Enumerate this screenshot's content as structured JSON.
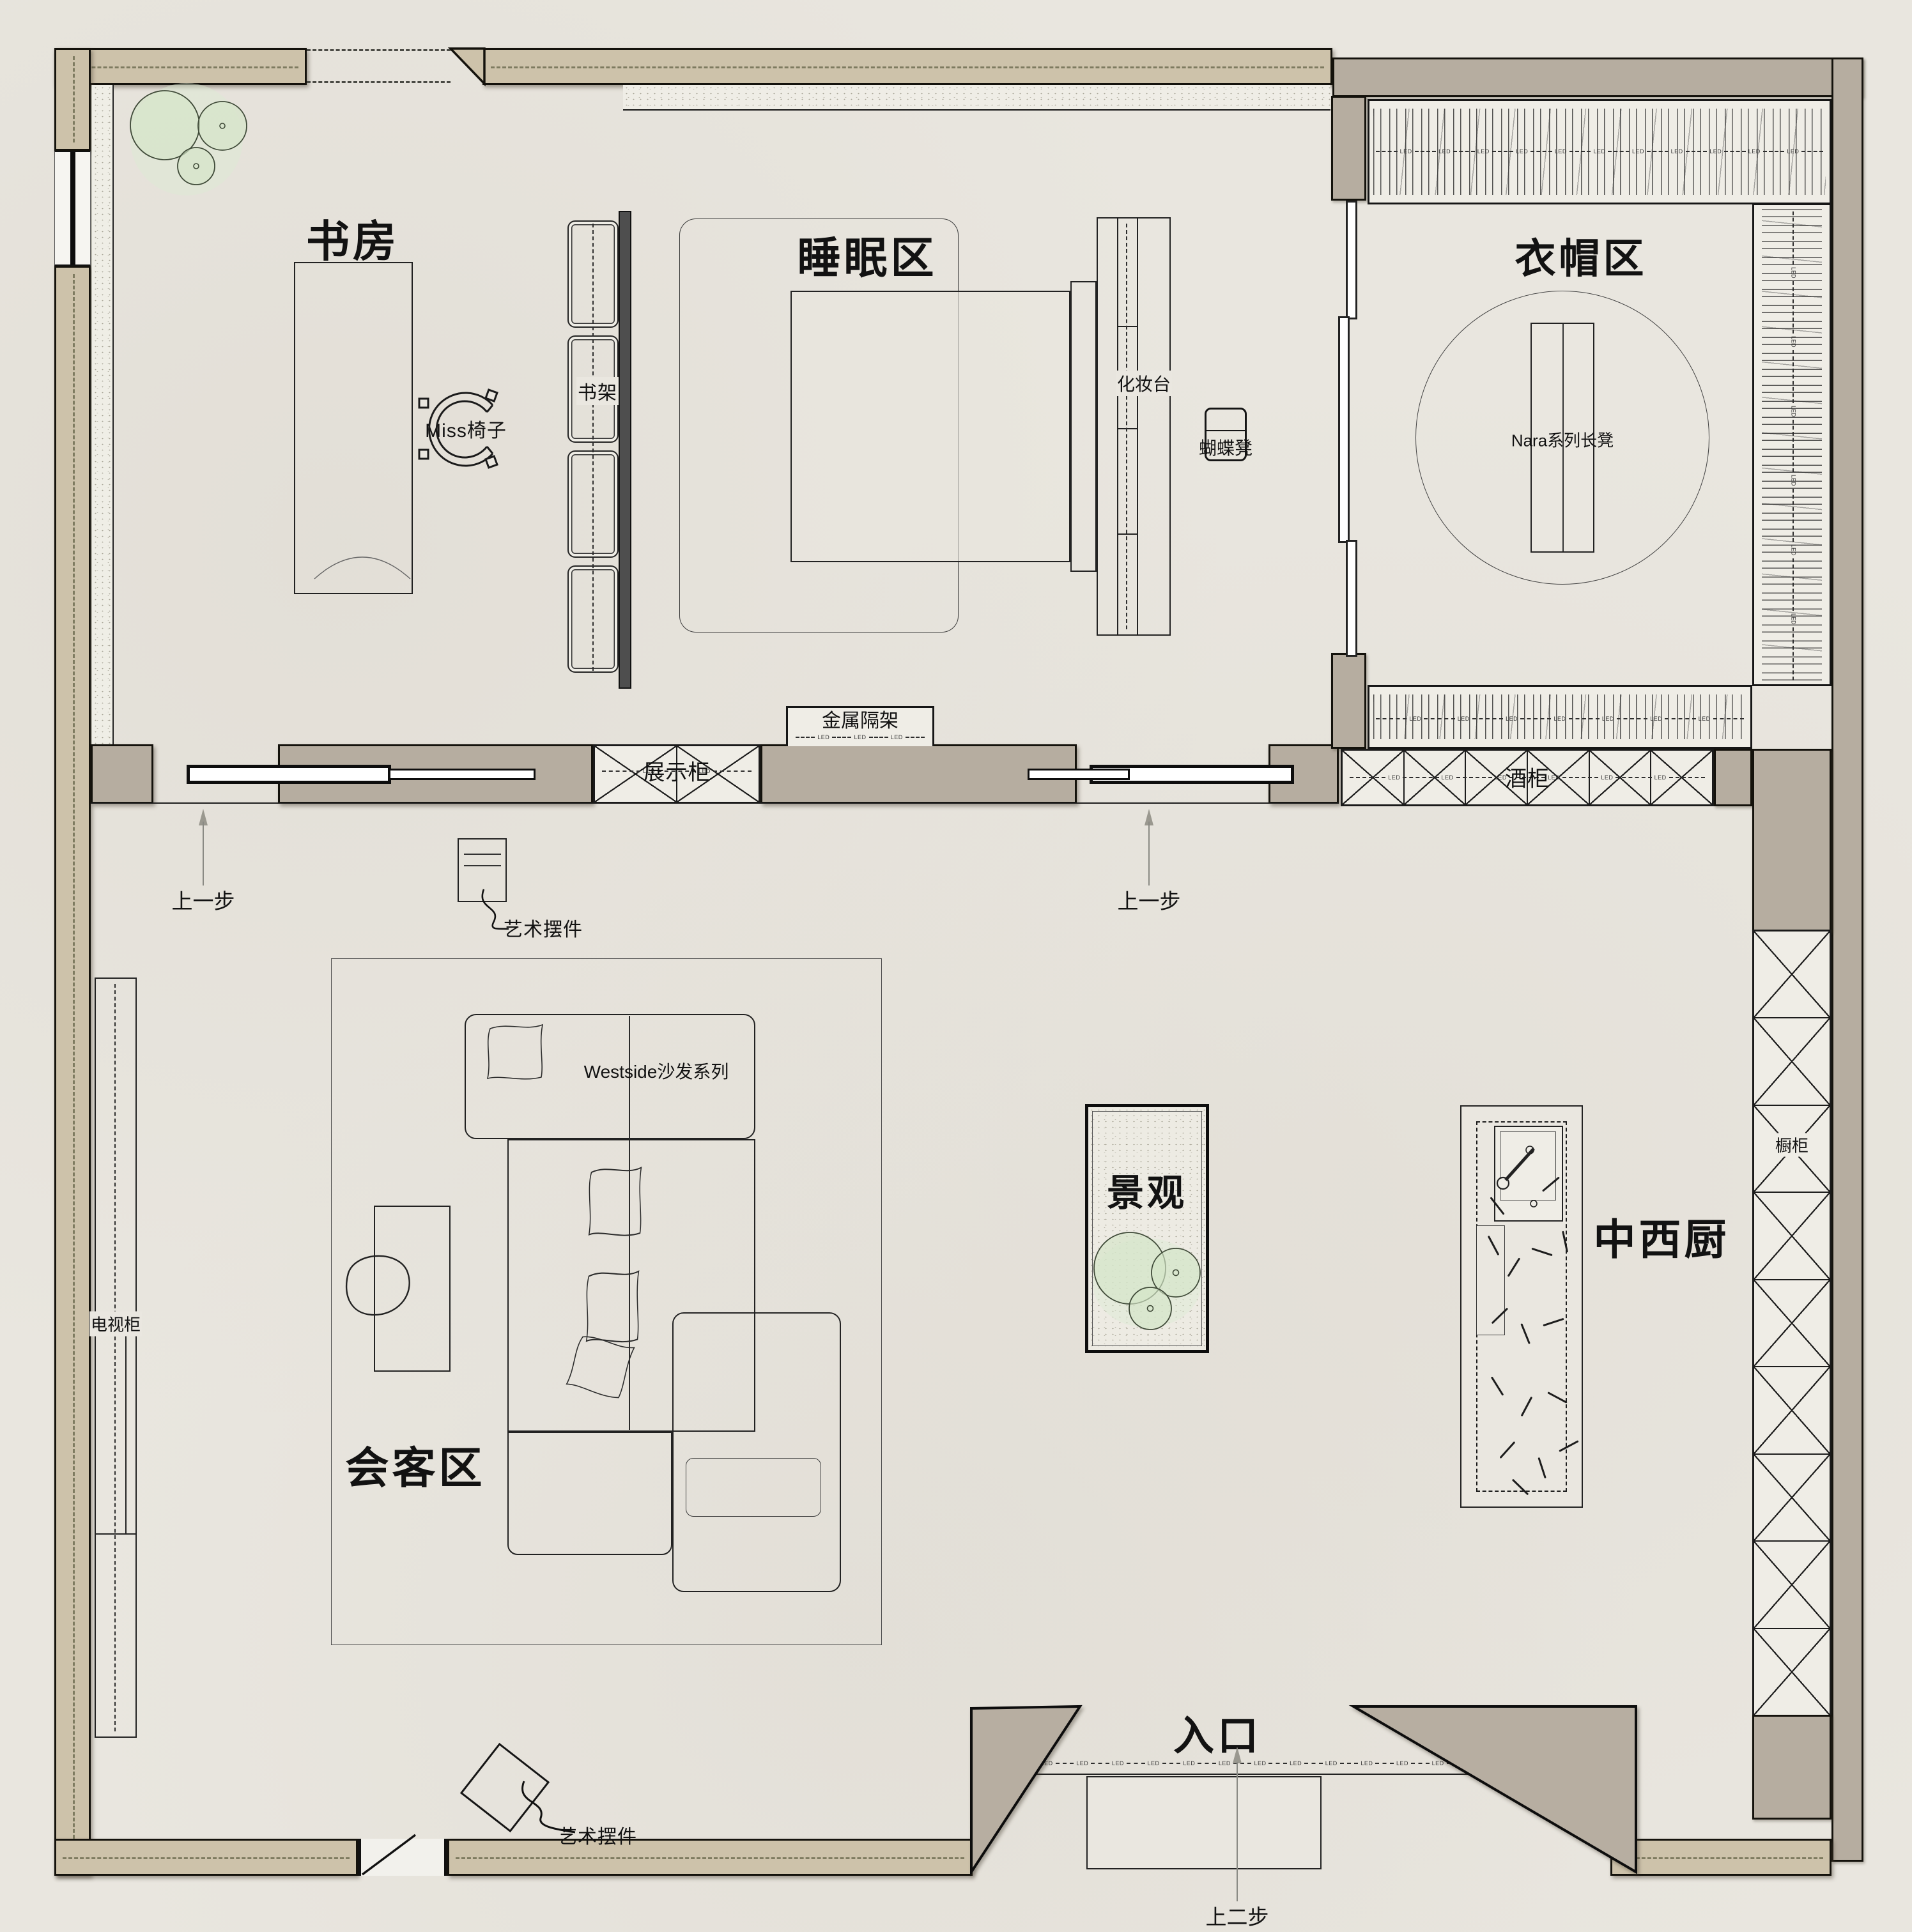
{
  "labels": {
    "study": "书房",
    "sleep": "睡眠区",
    "cloak": "衣帽区",
    "meeting": "会客区",
    "landscape": "景观",
    "kitchen": "中西厨",
    "entrance": "入口",
    "miss_chair": "Miss椅子",
    "bookshelf": "书架",
    "dresser": "化妆台",
    "butterfly_stool": "蝴蝶凳",
    "nara_bench": "Nara系列长凳",
    "metal_shelf": "金属隔架",
    "display_cabinet": "展示柜",
    "wine_cabinet": "酒柜",
    "tv_cabinet": "电视柜",
    "sofa_series": "Westside沙发系列",
    "cupboard": "橱柜",
    "art_item_1": "艺术摆件",
    "art_item_2": "艺术摆件",
    "step_up_1": "上一步",
    "step_up_2": "上一步",
    "step_up_two": "上二步",
    "led": "LED"
  },
  "colors": {
    "paper": "#e9e6df",
    "wall_tan": "#cdc2aa",
    "wall_gray": "#b6ada0",
    "line": "#1a1a1a",
    "tree_green": "#d4e5c8"
  }
}
